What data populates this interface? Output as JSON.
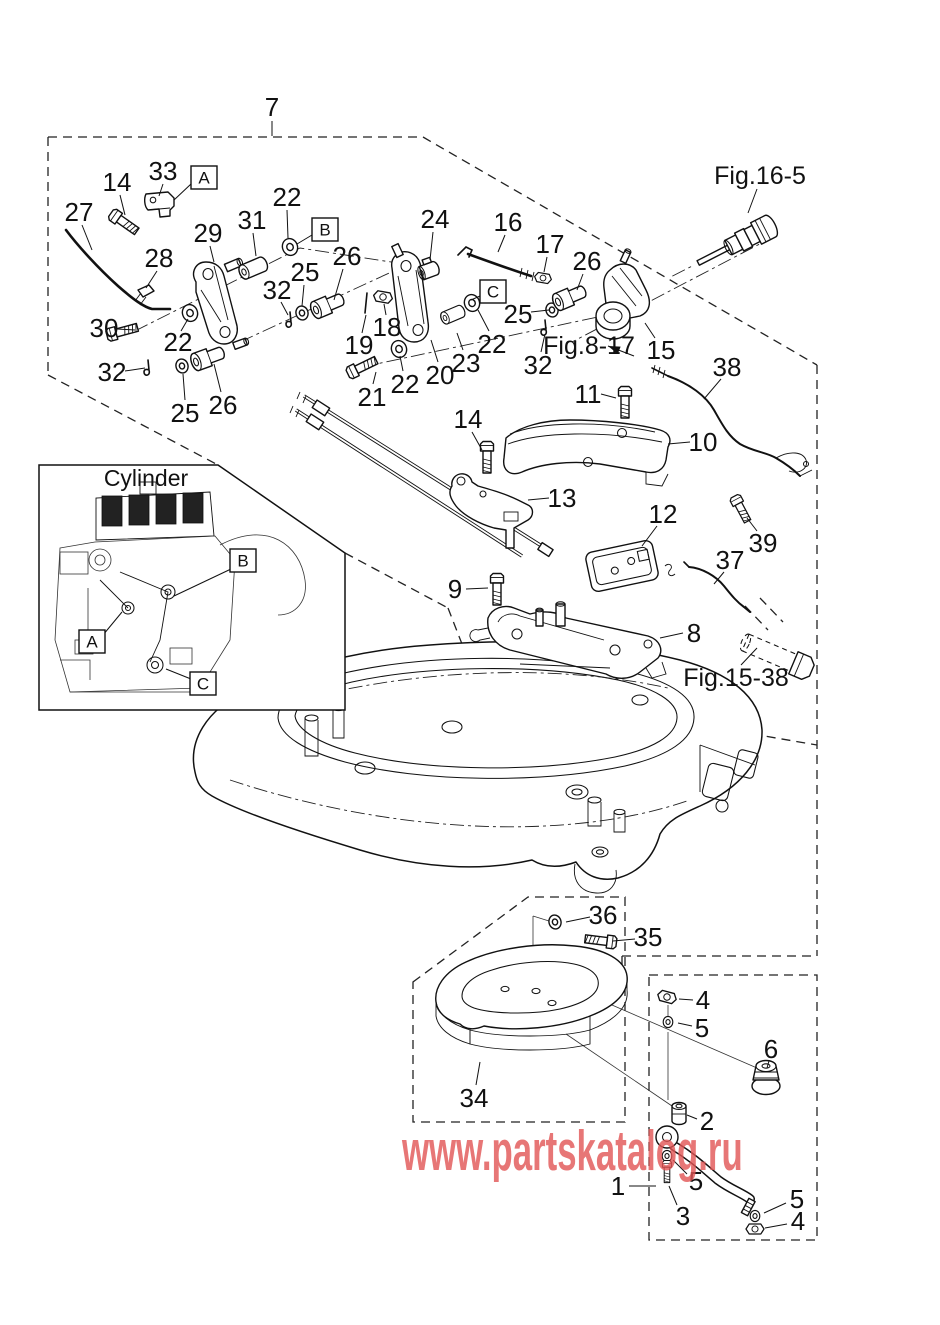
{
  "page": {
    "width": 940,
    "height": 1325,
    "background": "#ffffff",
    "line_color": "#111111"
  },
  "watermark": {
    "text": "www.partskatalog.ru",
    "color": "#e25555",
    "opacity": 0.8
  },
  "inset": {
    "title": "Cylinder"
  },
  "figure_refs": {
    "top_right": "Fig.16-5",
    "middle": "Fig.8-17",
    "lower_right": "Fig.15-38"
  },
  "labels": [
    {
      "text": "7",
      "x": 272,
      "y": 107,
      "leader": [
        272,
        121,
        272,
        136
      ]
    },
    {
      "text": "Fig.16-5",
      "x": 760,
      "y": 176,
      "size": 25,
      "leader": [
        757,
        189,
        748,
        213
      ]
    },
    {
      "text": "14",
      "x": 117,
      "y": 182,
      "leader": [
        120,
        195,
        125,
        215
      ]
    },
    {
      "text": "33",
      "x": 163,
      "y": 171,
      "leader": [
        163,
        184,
        159,
        196
      ]
    },
    {
      "text": "A",
      "x": 204,
      "y": 178,
      "boxed": true,
      "leader": [
        191,
        184,
        174,
        200
      ]
    },
    {
      "text": "27",
      "x": 79,
      "y": 212,
      "leader": [
        82,
        225,
        92,
        250
      ]
    },
    {
      "text": "22",
      "x": 287,
      "y": 197,
      "leader": [
        287,
        210,
        288,
        238
      ]
    },
    {
      "text": "B",
      "x": 325,
      "y": 230,
      "boxed": true,
      "leader": [
        312,
        235,
        297,
        244
      ]
    },
    {
      "text": "31",
      "x": 252,
      "y": 220,
      "leader": [
        253,
        233,
        256,
        256
      ]
    },
    {
      "text": "29",
      "x": 208,
      "y": 233,
      "leader": [
        210,
        246,
        214,
        262
      ]
    },
    {
      "text": "28",
      "x": 159,
      "y": 258,
      "leader": [
        157,
        271,
        146,
        288
      ]
    },
    {
      "text": "26",
      "x": 347,
      "y": 256,
      "leader": [
        343,
        269,
        334,
        300
      ]
    },
    {
      "text": "25",
      "x": 305,
      "y": 272,
      "leader": [
        304,
        285,
        302,
        306
      ]
    },
    {
      "text": "24",
      "x": 435,
      "y": 219,
      "leader": [
        433,
        232,
        430,
        260
      ]
    },
    {
      "text": "16",
      "x": 508,
      "y": 222,
      "leader": [
        505,
        235,
        498,
        252
      ]
    },
    {
      "text": "17",
      "x": 550,
      "y": 244,
      "leader": [
        547,
        257,
        544,
        272
      ]
    },
    {
      "text": "26",
      "x": 587,
      "y": 261,
      "leader": [
        583,
        274,
        577,
        290
      ]
    },
    {
      "text": "30",
      "x": 104,
      "y": 328,
      "leader": [
        117,
        329,
        135,
        330
      ]
    },
    {
      "text": "22",
      "x": 178,
      "y": 342,
      "leader": [
        181,
        331,
        188,
        319
      ]
    },
    {
      "text": "32",
      "x": 112,
      "y": 372,
      "leader": [
        125,
        371,
        145,
        368
      ]
    },
    {
      "text": "25",
      "x": 185,
      "y": 413,
      "leader": [
        185,
        400,
        183,
        374
      ]
    },
    {
      "text": "26",
      "x": 223,
      "y": 405,
      "leader": [
        221,
        392,
        214,
        364
      ]
    },
    {
      "text": "32",
      "x": 277,
      "y": 290,
      "leader": [
        281,
        302,
        288,
        315
      ]
    },
    {
      "text": "18",
      "x": 387,
      "y": 327,
      "leader": [
        386,
        315,
        384,
        304
      ]
    },
    {
      "text": "19",
      "x": 359,
      "y": 345,
      "leader": [
        362,
        333,
        366,
        315
      ]
    },
    {
      "text": "21",
      "x": 372,
      "y": 397,
      "leader": [
        373,
        384,
        376,
        372
      ]
    },
    {
      "text": "22",
      "x": 405,
      "y": 384,
      "leader": [
        403,
        371,
        400,
        356
      ]
    },
    {
      "text": "20",
      "x": 440,
      "y": 375,
      "leader": [
        438,
        362,
        431,
        340
      ]
    },
    {
      "text": "23",
      "x": 466,
      "y": 363,
      "leader": [
        463,
        350,
        457,
        333
      ]
    },
    {
      "text": "22",
      "x": 492,
      "y": 344,
      "leader": [
        489,
        331,
        478,
        310
      ]
    },
    {
      "text": "C",
      "x": 493,
      "y": 292,
      "boxed": true,
      "leader": [
        480,
        296,
        471,
        300
      ]
    },
    {
      "text": "25",
      "x": 518,
      "y": 314,
      "leader": [
        531,
        312,
        549,
        310
      ]
    },
    {
      "text": "32",
      "x": 538,
      "y": 365,
      "leader": [
        541,
        352,
        545,
        334
      ]
    },
    {
      "text": "Fig.8-17",
      "x": 589,
      "y": 346,
      "size": 25,
      "leader": [
        634,
        356,
        608,
        346
      ],
      "arrow": true
    },
    {
      "text": "15",
      "x": 661,
      "y": 350,
      "leader": [
        655,
        338,
        645,
        323
      ]
    },
    {
      "text": "38",
      "x": 727,
      "y": 367,
      "leader": [
        721,
        379,
        704,
        399
      ]
    },
    {
      "text": "11",
      "x": 588,
      "y": 394,
      "leader": [
        601,
        394,
        616,
        398
      ]
    },
    {
      "text": "14",
      "x": 468,
      "y": 419,
      "leader": [
        472,
        432,
        482,
        450
      ]
    },
    {
      "text": "10",
      "x": 703,
      "y": 442,
      "leader": [
        690,
        442,
        668,
        444
      ]
    },
    {
      "text": "13",
      "x": 562,
      "y": 498,
      "leader": [
        549,
        498,
        528,
        500
      ]
    },
    {
      "text": "12",
      "x": 663,
      "y": 514,
      "leader": [
        657,
        526,
        642,
        546
      ]
    },
    {
      "text": "39",
      "x": 763,
      "y": 543,
      "leader": [
        757,
        531,
        747,
        518
      ]
    },
    {
      "text": "37",
      "x": 730,
      "y": 560,
      "leader": [
        724,
        572,
        714,
        584
      ]
    },
    {
      "text": "9",
      "x": 455,
      "y": 589,
      "leader": [
        466,
        589,
        488,
        588
      ]
    },
    {
      "text": "8",
      "x": 694,
      "y": 633,
      "leader": [
        683,
        633,
        660,
        638
      ]
    },
    {
      "text": "Fig.15-38",
      "x": 736,
      "y": 678,
      "size": 25,
      "leader": [
        741,
        665,
        757,
        648
      ]
    },
    {
      "text": "A",
      "x": 92,
      "y": 642,
      "boxed": true,
      "leader": [
        103,
        635,
        122,
        612
      ]
    },
    {
      "text": "B",
      "x": 243,
      "y": 561,
      "boxed": true,
      "leader": [
        231,
        569,
        174,
        596
      ]
    },
    {
      "text": "C",
      "x": 203,
      "y": 684,
      "boxed": true,
      "leader": [
        191,
        679,
        166,
        669
      ]
    },
    {
      "text": "36",
      "x": 603,
      "y": 915,
      "leader": [
        590,
        917,
        566,
        922
      ]
    },
    {
      "text": "35",
      "x": 648,
      "y": 937,
      "leader": [
        635,
        939,
        613,
        941
      ]
    },
    {
      "text": "34",
      "x": 474,
      "y": 1098,
      "leader": [
        476,
        1085,
        480,
        1062
      ]
    },
    {
      "text": "4",
      "x": 703,
      "y": 1000,
      "leader": [
        693,
        1000,
        679,
        999
      ]
    },
    {
      "text": "5",
      "x": 702,
      "y": 1028,
      "leader": [
        692,
        1026,
        678,
        1023
      ]
    },
    {
      "text": "6",
      "x": 771,
      "y": 1049,
      "leader": [
        769,
        1061,
        767,
        1068
      ]
    },
    {
      "text": "2",
      "x": 707,
      "y": 1121,
      "leader": [
        697,
        1119,
        687,
        1115
      ]
    },
    {
      "text": "1",
      "x": 618,
      "y": 1186,
      "leader": [
        629,
        1186,
        656,
        1186
      ]
    },
    {
      "text": "5",
      "x": 696,
      "y": 1181,
      "leader": [
        687,
        1174,
        673,
        1160
      ]
    },
    {
      "text": "3",
      "x": 683,
      "y": 1216,
      "leader": [
        677,
        1205,
        669,
        1186
      ]
    },
    {
      "text": "5",
      "x": 797,
      "y": 1199,
      "leader": [
        786,
        1203,
        764,
        1213
      ]
    },
    {
      "text": "4",
      "x": 798,
      "y": 1221,
      "leader": [
        787,
        1224,
        765,
        1228
      ]
    }
  ]
}
